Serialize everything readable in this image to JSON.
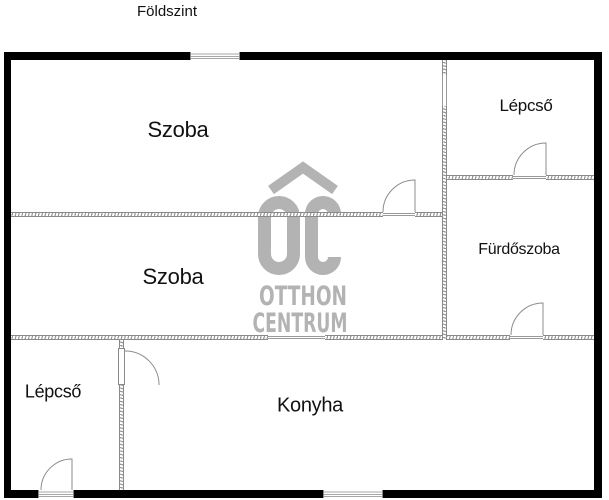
{
  "title": "Földszint",
  "rooms": {
    "szoba_top": {
      "label": "Szoba"
    },
    "szoba_middle": {
      "label": "Szoba"
    },
    "lepcso_top": {
      "label": "Lépcső"
    },
    "furdoszoba": {
      "label": "Fürdőszoba"
    },
    "lepcso_bottom": {
      "label": "Lépcső"
    },
    "konyha": {
      "label": "Konyha"
    }
  },
  "watermark": {
    "logo_initials": "OC",
    "line1": "OTTHON",
    "line2": "CENTRUM",
    "color": "#b3b3b3"
  },
  "colors": {
    "background": "#ffffff",
    "outer_wall": "#000000",
    "interior_wall_line": "#8a8a8a",
    "door_line": "#8c8c8c",
    "text": "#111111"
  }
}
